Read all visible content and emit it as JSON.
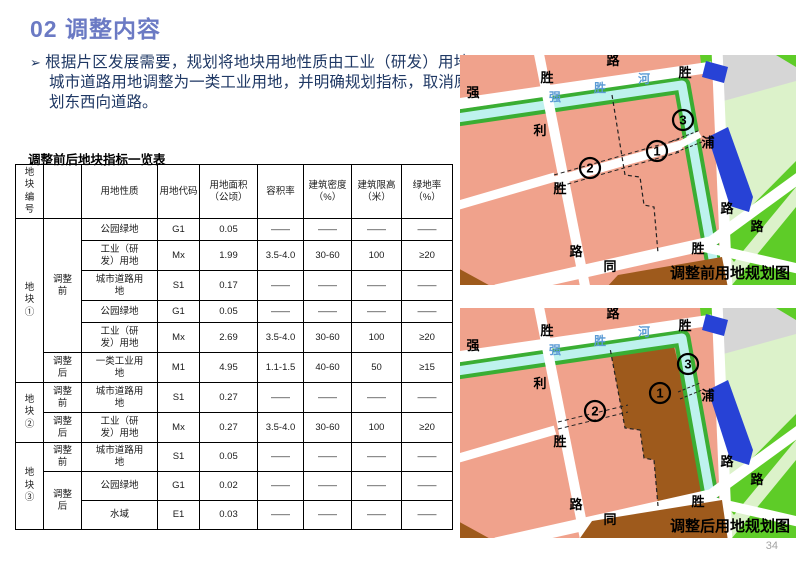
{
  "title": "02 调整内容",
  "bullet": {
    "marker": "➢",
    "text": "根据片区发展需要，规划将地块用地性质由工业（研发）用地、城市道路用地调整为一类工业用地，并明确规划指标，取消原规划东西向道路。"
  },
  "table": {
    "title": "调整前后地块指标一览表",
    "headers": [
      "地块编号",
      "",
      "用地性质",
      "用地代码",
      "用地面积（公顷）",
      "容积率",
      "建筑密度（%）",
      "建筑限高（米）",
      "绿地率（%）"
    ],
    "groups": [
      {
        "block": "地块①",
        "phases": [
          {
            "label": "调整前",
            "rows": [
              [
                "公园绿地",
                "G1",
                "0.05",
                "——",
                "——",
                "——",
                "——"
              ],
              [
                "工业（研发）用地",
                "Mx",
                "1.99",
                "3.5-4.0",
                "30-60",
                "100",
                "≥20"
              ],
              [
                "城市道路用地",
                "S1",
                "0.17",
                "——",
                "——",
                "——",
                "——"
              ],
              [
                "公园绿地",
                "G1",
                "0.05",
                "——",
                "——",
                "——",
                "——"
              ],
              [
                "工业（研发）用地",
                "Mx",
                "2.69",
                "3.5-4.0",
                "30-60",
                "100",
                "≥20"
              ]
            ]
          },
          {
            "label": "调整后",
            "rows": [
              [
                "一类工业用地",
                "M1",
                "4.95",
                "1.1-1.5",
                "40-60",
                "50",
                "≥15"
              ]
            ]
          }
        ]
      },
      {
        "block": "地块②",
        "phases": [
          {
            "label": "调整前",
            "rows": [
              [
                "城市道路用地",
                "S1",
                "0.27",
                "——",
                "——",
                "——",
                "——"
              ]
            ]
          },
          {
            "label": "调整后",
            "rows": [
              [
                "工业（研发）用地",
                "Mx",
                "0.27",
                "3.5-4.0",
                "30-60",
                "100",
                "≥20"
              ]
            ]
          }
        ]
      },
      {
        "block": "地块③",
        "phases": [
          {
            "label": "调整前",
            "rows": [
              [
                "城市道路用地",
                "S1",
                "0.05",
                "——",
                "——",
                "——",
                "——"
              ]
            ]
          },
          {
            "label": "调整后",
            "rows": [
              [
                "公园绿地",
                "G1",
                "0.02",
                "——",
                "——",
                "——",
                "——"
              ],
              [
                "水域",
                "E1",
                "0.03",
                "——",
                "——",
                "——",
                "——"
              ]
            ]
          }
        ]
      }
    ]
  },
  "maps": {
    "before": {
      "caption": "调整前用地规划图"
    },
    "after": {
      "caption": "调整后用地规划图"
    },
    "road_labels": [
      "强",
      "胜",
      "路",
      "胜",
      "利",
      "胜",
      "路",
      "同",
      "胜",
      "浦",
      "路",
      "路"
    ],
    "river_name": [
      "强",
      "胜",
      "河"
    ],
    "markers": [
      "1",
      "2",
      "3"
    ]
  },
  "page": {
    "number": "34"
  },
  "colors": {
    "title_blue": "#6B7AC4",
    "body_navy": "#1F3864",
    "map_pink": "#F0A28C",
    "map_brown": "#9E5A1C",
    "river_cyan": "#BEF2EE",
    "bank_green": "#3AAE33",
    "bright_green": "#5ECC28",
    "pale_green": "#DCF2CA",
    "gray_area": "#D6D6D6",
    "building_blue": "#2742D6",
    "river_text_blue": "#5B9BD5",
    "label_black": "#000000"
  }
}
